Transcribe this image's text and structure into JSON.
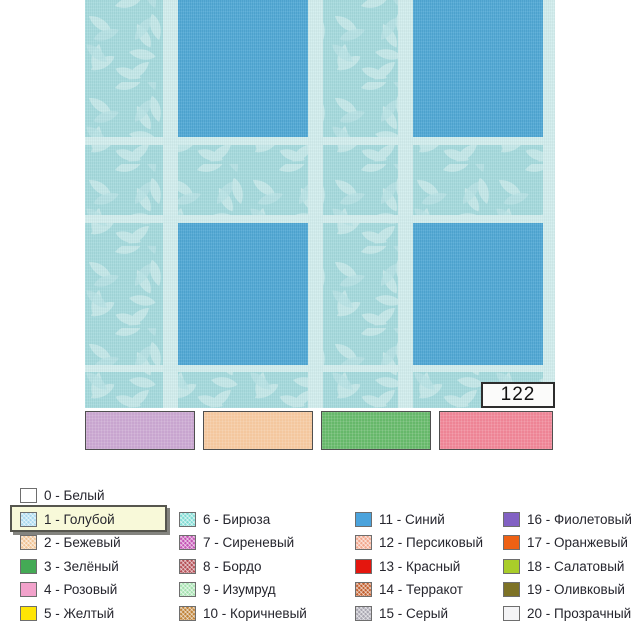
{
  "pattern": {
    "code": "122",
    "colors": {
      "base": "#a5dadd",
      "leaf": "#c6e9ea",
      "square": "#4fa8d5",
      "stripe": "#d2eeee",
      "code_box_bg": "#fbfbfa"
    }
  },
  "samples": [
    {
      "color": "#c8a5cf"
    },
    {
      "color": "#f4c79e"
    },
    {
      "color": "#66b86a"
    },
    {
      "color": "#ee8495"
    }
  ],
  "legend": {
    "selected_label": "1 - Голубой",
    "highlight_bg": "#f8f9d9",
    "items": [
      {
        "label": "0 - Белый",
        "color": "#ffffff",
        "hatch": false
      },
      {
        "label": "1 - Голубой",
        "color": "#aad9ef",
        "hatch": true
      },
      {
        "label": "2 - Бежевый",
        "color": "#f0c394",
        "hatch": true
      },
      {
        "label": "3 - Зелёный",
        "color": "#44aa55",
        "hatch": false
      },
      {
        "label": "4 - Розовый",
        "color": "#f2a2cb",
        "hatch": false
      },
      {
        "label": "5 - Желтый",
        "color": "#ffe505",
        "hatch": false
      },
      {
        "label": "6 - Бирюза",
        "color": "#80dcd4",
        "hatch": true
      },
      {
        "label": "7 - Сиреневый",
        "color": "#c455b5",
        "hatch": true
      },
      {
        "label": "8 - Бордо",
        "color": "#b54f56",
        "hatch": true
      },
      {
        "label": "9 - Изумруд",
        "color": "#a5e2b0",
        "hatch": true
      },
      {
        "label": "10 - Коричневый",
        "color": "#c08338",
        "hatch": true
      },
      {
        "label": "11 - Синий",
        "color": "#4ba3dc",
        "hatch": false
      },
      {
        "label": "12 - Персиковый",
        "color": "#f2a78d",
        "hatch": true
      },
      {
        "label": "13 - Красный",
        "color": "#e4160e",
        "hatch": false
      },
      {
        "label": "14 - Терракот",
        "color": "#c3602f",
        "hatch": true
      },
      {
        "label": "15 - Серый",
        "color": "#a9a7b2",
        "hatch": true
      },
      {
        "label": "16 - Фиолетовый",
        "color": "#8261c3",
        "hatch": false
      },
      {
        "label": "17 - Оранжевый",
        "color": "#ee6114",
        "hatch": false
      },
      {
        "label": "18 - Салатовый",
        "color": "#a9cd2a",
        "hatch": false
      },
      {
        "label": "19 - Оливковый",
        "color": "#7d7226",
        "hatch": false
      },
      {
        "label": "20 - Прозрачный",
        "color": "#f4f4f6",
        "hatch": false
      }
    ]
  }
}
